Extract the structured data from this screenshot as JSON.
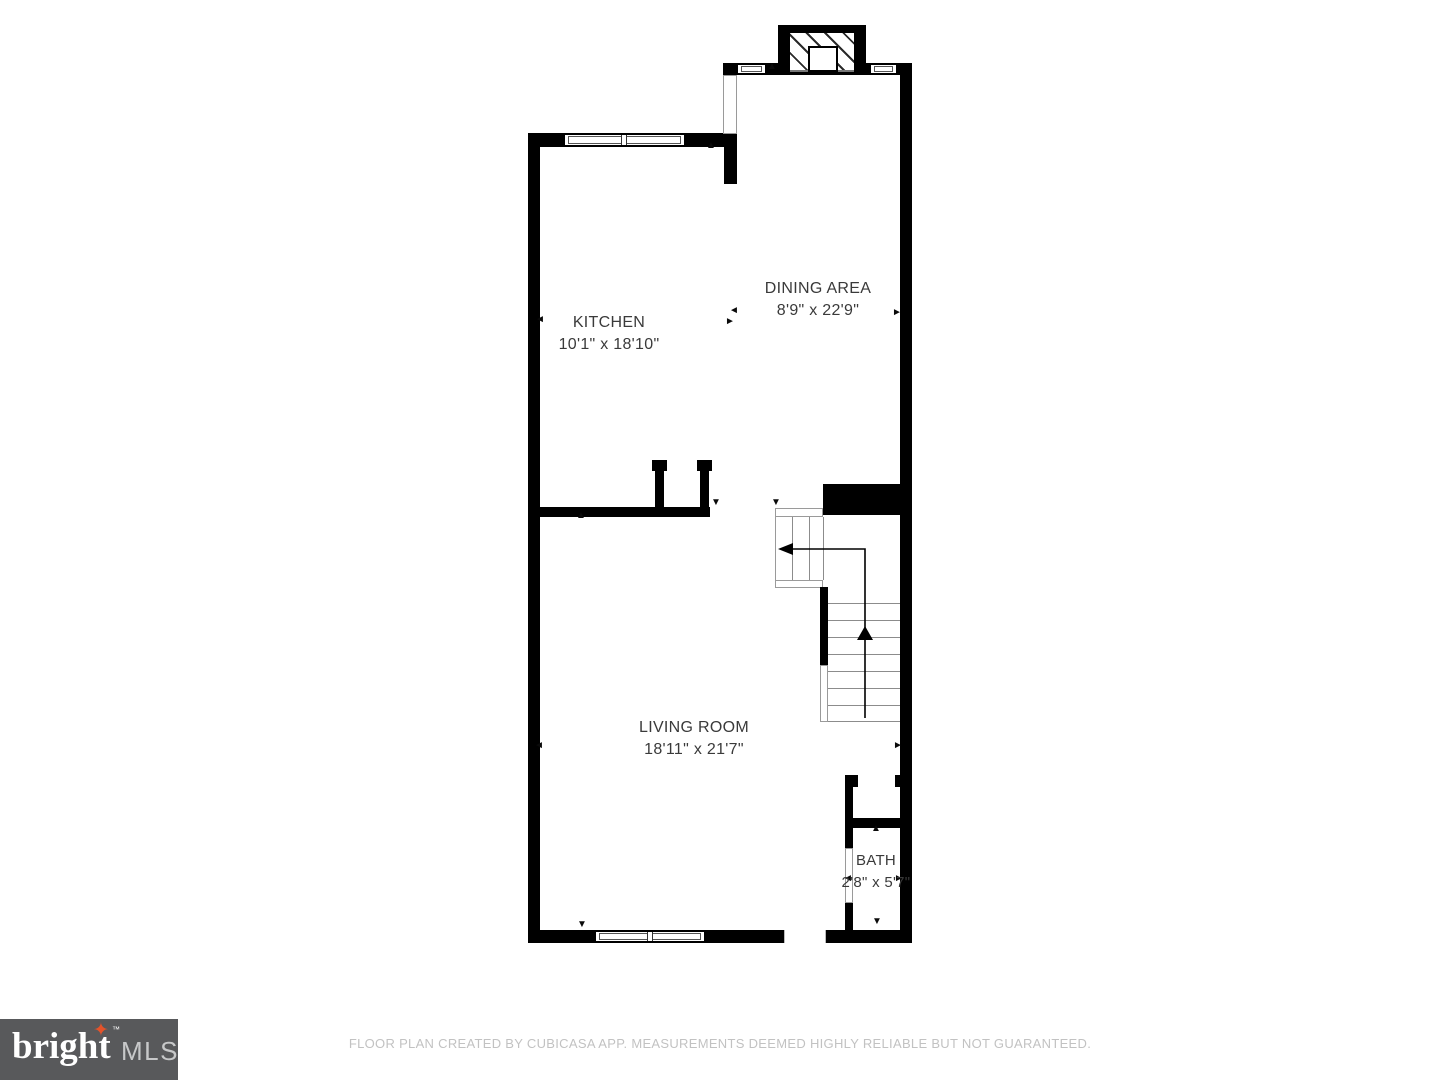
{
  "plan": {
    "creator_note": "floor-plan of main level with kitchen, dining area, living room, bath and stairs",
    "rooms": [
      {
        "name": "KITCHEN",
        "dimensions": "10'1\" x 18'10\""
      },
      {
        "name": "DINING AREA",
        "dimensions": "8'9\" x 22'9\""
      },
      {
        "name": "LIVING ROOM",
        "dimensions": "18'11\" x 21'7\""
      },
      {
        "name": "BATH",
        "dimensions": "2'8\" x 5'7\""
      }
    ]
  },
  "icons": {
    "arrow_up": "▲",
    "arrow_down": "▼",
    "arrow_left": "◄",
    "arrow_right": "►",
    "star": "✦"
  },
  "branding": {
    "logo_word": "bright",
    "logo_tm": "™",
    "logo_suffix": "MLS",
    "logo_bg": "#58595b",
    "logo_star_color": "#e4532a"
  },
  "footer": {
    "disclaimer": "FLOOR PLAN CREATED BY CUBICASA APP. MEASUREMENTS DEEMED HIGHLY RELIABLE BUT NOT GUARANTEED."
  },
  "colors": {
    "wall": "#000000",
    "background": "#ffffff",
    "room_text": "#3a3a3a",
    "stair_line": "#8c8c8c",
    "footer_text": "#c2c2c2"
  }
}
